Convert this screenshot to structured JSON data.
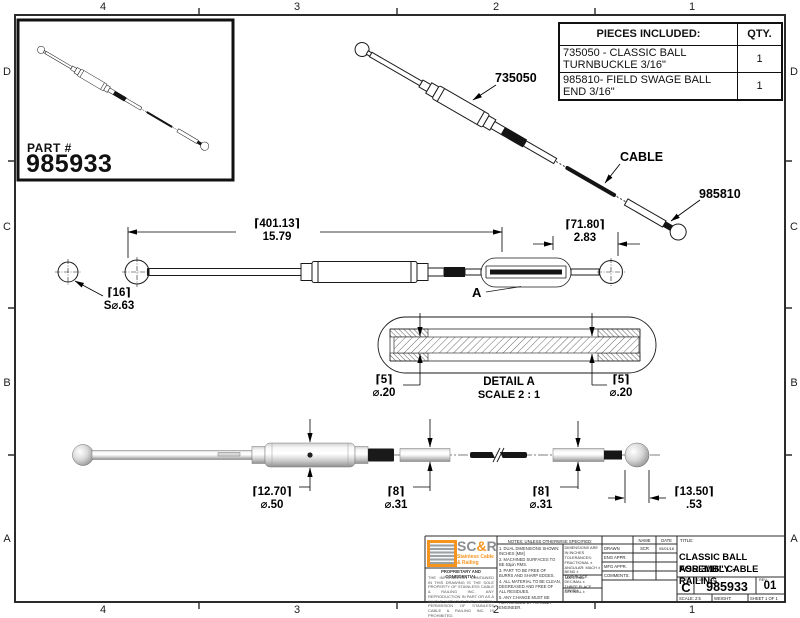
{
  "zones": {
    "columns": [
      "4",
      "3",
      "2",
      "1"
    ],
    "rows": [
      "D",
      "C",
      "B",
      "A"
    ]
  },
  "part_box": {
    "label": "PART #",
    "number": "985933"
  },
  "pieces_table": {
    "header_desc": "PIECES INCLUDED:",
    "header_qty": "QTY.",
    "rows": [
      {
        "desc": "735050 - CLASSIC BALL TURNBUCKLE 3/16\"",
        "qty": "1"
      },
      {
        "desc": "985810- FIELD SWAGE BALL END 3/16\"",
        "qty": "1"
      }
    ]
  },
  "labels": {
    "turnbuckle": "735050",
    "cable": "CABLE",
    "swage_end": "985810",
    "detail_ref": "A"
  },
  "dimensions": {
    "overall": {
      "mm": "⌈401.13⌉",
      "in": "15.79"
    },
    "swage_length": {
      "mm": "⌈71.80⌉",
      "in": "2.83"
    },
    "ball_sphere": {
      "mm": "⌈16⌉",
      "in": "S⌀.63"
    },
    "detail_cable_left": {
      "mm": "⌈5⌉",
      "in": "⌀.20"
    },
    "detail_cable_right": {
      "mm": "⌈5⌉",
      "in": "⌀.20"
    },
    "body_dia": {
      "mm": "⌈12.70⌉",
      "in": "⌀.50"
    },
    "stud_dia": {
      "mm": "⌈8⌉",
      "in": "⌀.31"
    },
    "swage_dia": {
      "mm": "⌈8⌉",
      "in": "⌀.31"
    },
    "ball_dia": {
      "mm": "⌈13.50⌉",
      "in": ".53"
    }
  },
  "detail_a": {
    "title": "DETAIL A",
    "scale": "SCALE 2 : 1"
  },
  "title_block": {
    "logo": {
      "p1": "SC",
      "amp": "&",
      "p2": "R",
      "tag1": "Stainless Cable",
      "tag2": "& Railing"
    },
    "proprietary_heading": "PROPRIETARY AND CONFIDENTIAL",
    "proprietary_text": "THE INFORMATION CONTAINED IN THIS DRAWING IS THE SOLE PROPERTY OF STAINLESS CABLE & RAILING INC. ANY REPRODUCTION IN PART OR AS A WHOLE WITHOUT THE WRITTEN PERMISSION OF STAINLESS CABLE & RAILING INC. IS PROHIBITED.",
    "notes_heading": "NOTES: UNLESS OTHERWISE SPECIFIED:",
    "notes": [
      "1. DUAL DIMENSIONS SHOWN: INCHES [MM]",
      "2. MACHINED SURFACES TO BE 63µin RMS.",
      "3. PART TO BE FREE OF BURRS AND SHARP EDGES.",
      "4. ALL MATERIAL TO BE CLEAN, DEGREASED AND FREE OF ALL RESIDUES.",
      "5. ANY CHANGE MUST BE AUTHORIZED BY AN SC&R ENGINEER."
    ],
    "tolerances": [
      "DIMENSIONS ARE IN INCHES",
      "TOLERANCES:",
      "FRACTIONAL ±",
      "ANGULAR: MACH ± BEND ±",
      "TWO PLACE DECIMAL ±",
      "THREE PLACE DECIMAL ±"
    ],
    "material_label": "MATERIAL",
    "finish_label": "FINISH",
    "approvals": {
      "name_header": "NAME",
      "date_header": "DATE",
      "drawn_label": "DRAWN",
      "drawn_name": "SCR",
      "drawn_date": "05/01/18",
      "eng_label": "ENG APPR.",
      "mfg_label": "MFG APPR.",
      "comments_label": "COMMENTS:"
    },
    "title_label": "TITLE:",
    "title_lines": [
      "CLASSIC BALL ASSEMBLY -",
      "FOR 3/16\" CABLE RAILING"
    ],
    "size_label": "SIZE",
    "size": "C",
    "dwg_label": "DWG.  NO.",
    "dwg_no": "985933",
    "rev_label": "REV",
    "rev": "01",
    "scale": "SCALE: 2:5",
    "weight": "WEIGHT:",
    "sheet": "SHEET 1 OF 1"
  },
  "colors": {
    "accent_orange": "#F7941E",
    "logo_gray": "#8B8D90",
    "line": "#1a1a1a"
  }
}
